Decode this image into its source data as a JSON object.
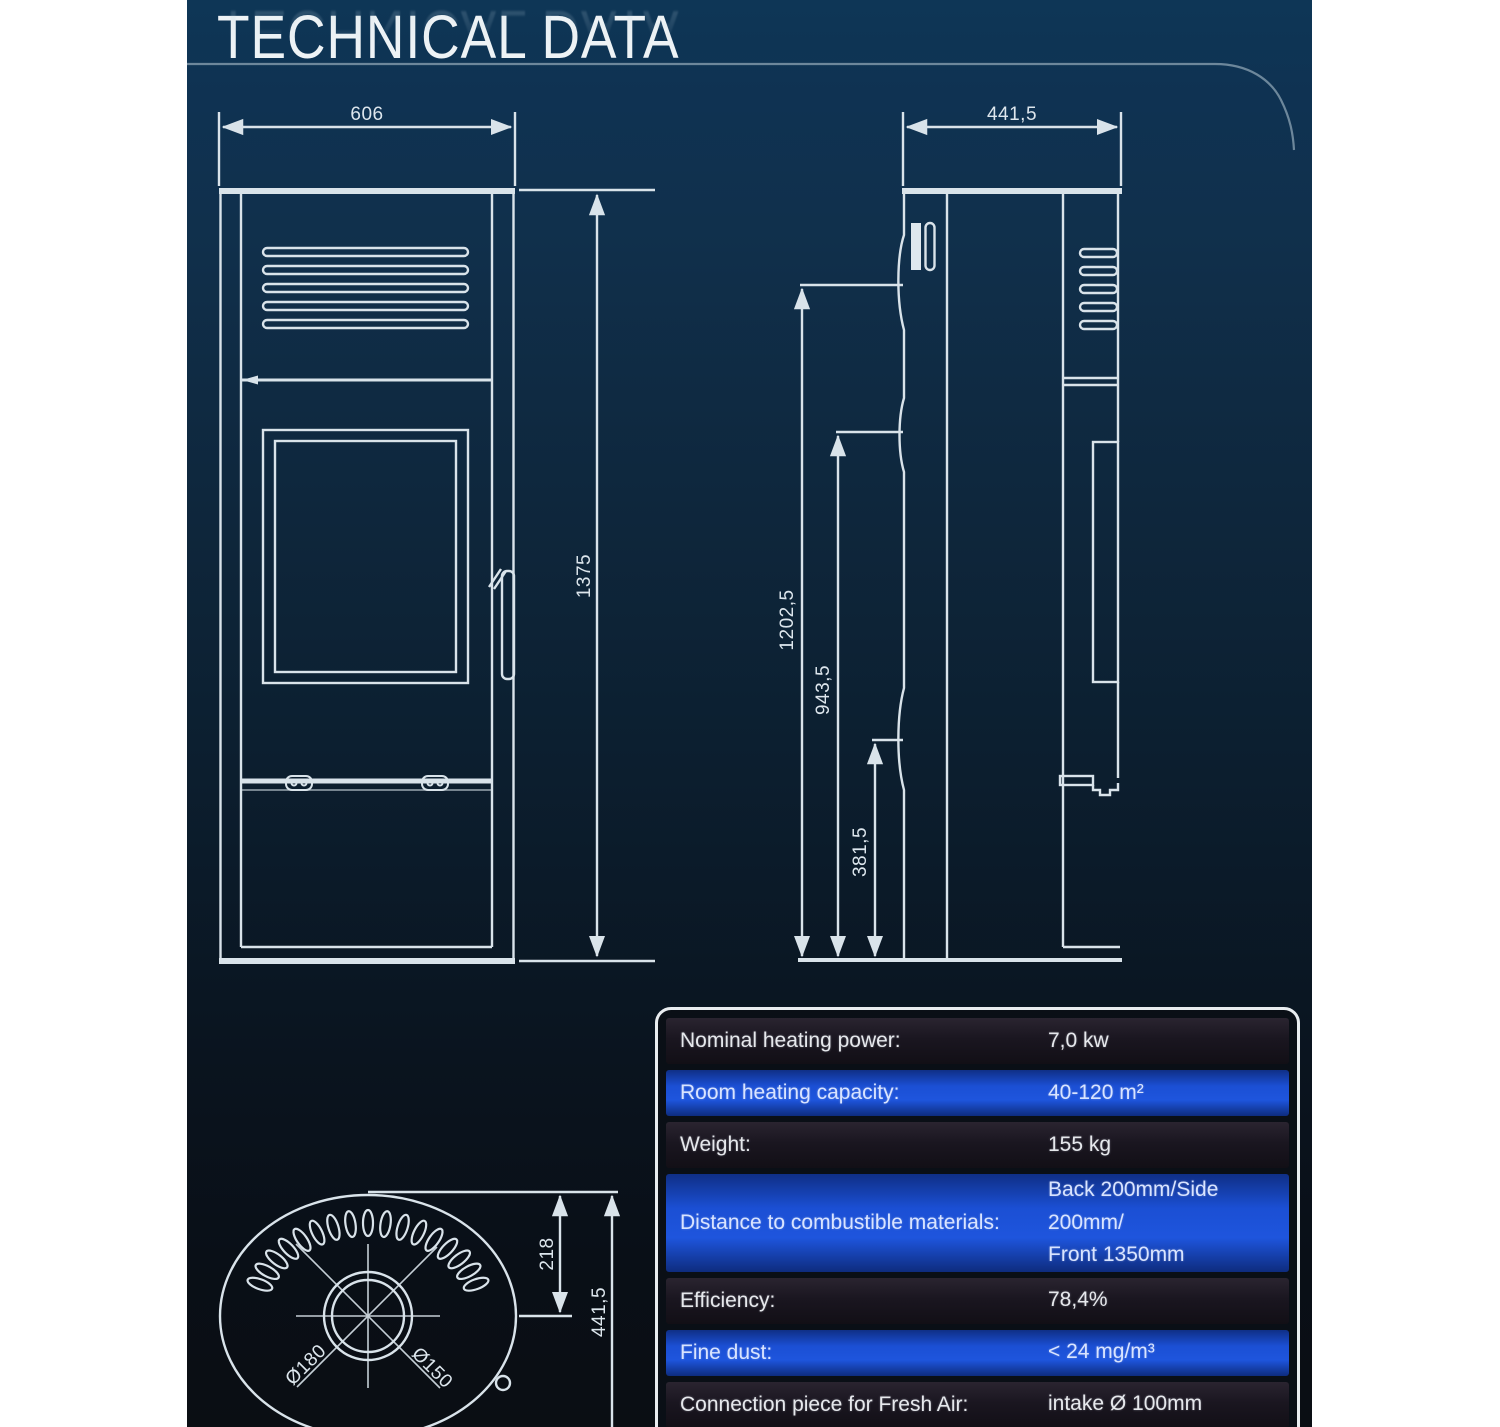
{
  "title": "TECHNICAL DATA",
  "front_view": {
    "width": "606",
    "height": "1375"
  },
  "side_view": {
    "depth": "441,5",
    "dim_total": "1202,5",
    "dim_mid": "943,5",
    "dim_low": "381,5"
  },
  "top_view": {
    "flue_offset": "218",
    "depth": "441,5",
    "flue_outer_diameter": "Ø180",
    "flue_inner_diameter": "Ø150"
  },
  "table": {
    "rows": [
      {
        "label": "Nominal heating power:",
        "value": "7,0 kw"
      },
      {
        "label": "Room heating capacity:",
        "value": "40-120 m²"
      },
      {
        "label": "Weight:",
        "value": "155 kg"
      },
      {
        "label": "Distance to combustible materials:",
        "value": "Back 200mm/Side 200mm/",
        "value2": "Front 1350mm"
      },
      {
        "label": "Efficiency:",
        "value": "78,4%"
      },
      {
        "label": "Fine dust:",
        "value": "< 24 mg/m³"
      },
      {
        "label": "Connection piece for Fresh Air:",
        "value": "intake Ø 100mm"
      }
    ]
  },
  "colors": {
    "accent_blue": "#1e55dd",
    "row_dark": "#1a1620",
    "drawing_line": "#d9e3ea",
    "panel_top": "#0e3656",
    "panel_bottom": "#0a0e13"
  }
}
